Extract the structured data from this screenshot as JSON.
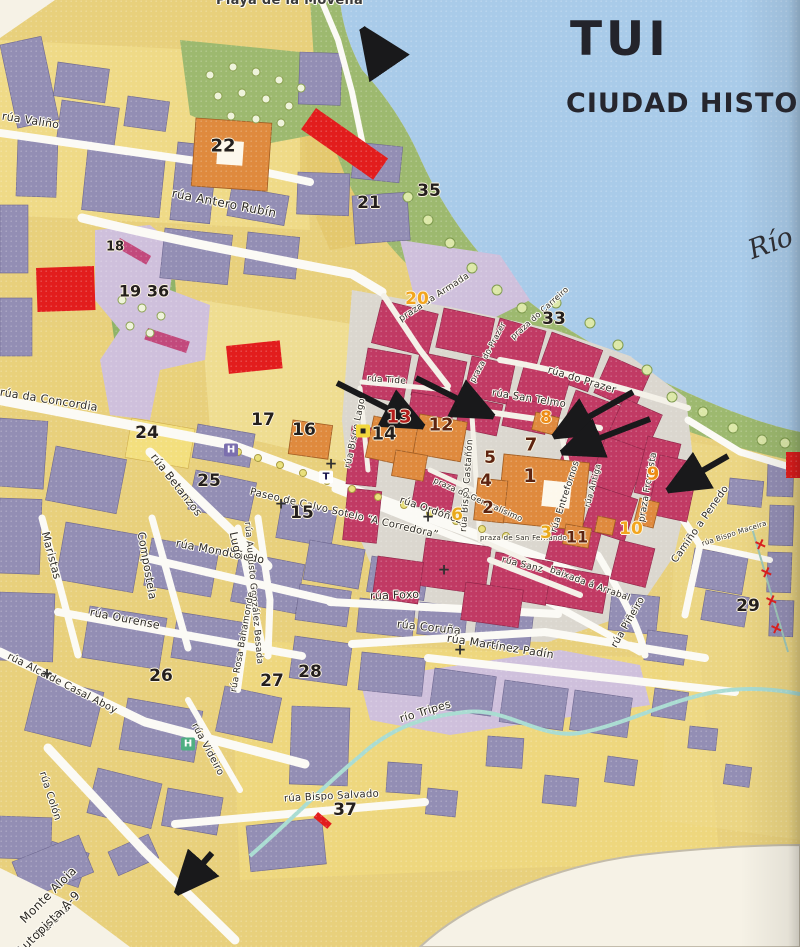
{
  "page": {
    "title": "TUI",
    "subtitle": "CIUDAD HISTO",
    "river_label": "Río",
    "beach_label": "Playa de la Movella"
  },
  "colors": {
    "water": "#a9cbe9",
    "shore_green": "#9db96f",
    "old_town_block": "#c13a64",
    "modern_block": "#938eb4",
    "monument_orange": "#df8a3e",
    "highlight_red": "#e21d1d",
    "street_white": "#fbfaf5",
    "lavender_zone": "#cfc0dc",
    "number_black": "#241f1d",
    "number_brown": "#5e2410",
    "number_orange": "#ee8b15",
    "number_yellow": "#e9a91c"
  },
  "streets": [
    {
      "t": "rúa Valiño",
      "x": 2,
      "y": 116,
      "r": 9,
      "s": 11
    },
    {
      "t": "rúa Antero Rubín",
      "x": 172,
      "y": 193,
      "r": 11,
      "s": 12
    },
    {
      "t": "praza da Armada",
      "x": 400,
      "y": 320,
      "r": -33,
      "s": 9
    },
    {
      "t": "praza do Carreiro",
      "x": 512,
      "y": 338,
      "r": -42,
      "s": 8
    },
    {
      "t": "praza do Prazer",
      "x": 472,
      "y": 382,
      "r": -62,
      "s": 8
    },
    {
      "t": "rúa do Prazer",
      "x": 548,
      "y": 370,
      "r": 17,
      "s": 10
    },
    {
      "t": "rúa San Telmo",
      "x": 492,
      "y": 393,
      "r": 9,
      "s": 10
    },
    {
      "t": "rúa Tide",
      "x": 367,
      "y": 379,
      "r": 4,
      "s": 9
    },
    {
      "t": "rúa Bispo Lago",
      "x": 348,
      "y": 468,
      "r": -78,
      "s": 9
    },
    {
      "t": "rúa Bispo Castañón",
      "x": 464,
      "y": 532,
      "r": -86,
      "s": 9
    },
    {
      "t": "rúa da Concordia",
      "x": 0,
      "y": 392,
      "r": 9,
      "s": 11
    },
    {
      "t": "rúa Betanzos",
      "x": 153,
      "y": 455,
      "r": 52,
      "s": 11
    },
    {
      "t": "rúa Mondoñedo",
      "x": 176,
      "y": 543,
      "r": 11,
      "s": 11
    },
    {
      "t": "Lugo",
      "x": 233,
      "y": 532,
      "r": 78,
      "s": 11
    },
    {
      "t": "Compostela",
      "x": 141,
      "y": 532,
      "r": 80,
      "s": 11
    },
    {
      "t": "Maristas",
      "x": 45,
      "y": 532,
      "r": 75,
      "s": 11
    },
    {
      "t": "rúa Ourense",
      "x": 90,
      "y": 612,
      "r": 11,
      "s": 11
    },
    {
      "t": "rúa Alcalde Casal Aboy",
      "x": 8,
      "y": 656,
      "r": 27,
      "s": 10
    },
    {
      "t": "rúa Colón",
      "x": 42,
      "y": 772,
      "r": 72,
      "s": 10
    },
    {
      "t": "rúa Augusto González Besada",
      "x": 247,
      "y": 522,
      "r": 85,
      "s": 9
    },
    {
      "t": "Paseo de Calvo Sotelo “A Corredora”",
      "x": 250,
      "y": 492,
      "r": 13,
      "s": 10
    },
    {
      "t": "rúa Ordóñez",
      "x": 400,
      "y": 500,
      "r": 19,
      "s": 10
    },
    {
      "t": "rúa Foxo",
      "x": 370,
      "y": 596,
      "r": -2,
      "s": 11
    },
    {
      "t": "rúa Coruña",
      "x": 397,
      "y": 624,
      "r": 6,
      "s": 11
    },
    {
      "t": "rúa Martínez Padín",
      "x": 447,
      "y": 638,
      "r": 9,
      "s": 11
    },
    {
      "t": "rúa Rosa Bahamonde",
      "x": 234,
      "y": 692,
      "r": -80,
      "s": 9
    },
    {
      "t": "río Tripes",
      "x": 400,
      "y": 719,
      "r": -17,
      "s": 11
    },
    {
      "t": "rúa Bispo Salvado",
      "x": 284,
      "y": 799,
      "r": -3,
      "s": 10
    },
    {
      "t": "rúa Videiro",
      "x": 194,
      "y": 724,
      "r": 62,
      "s": 10
    },
    {
      "t": "rúa Entrefornos",
      "x": 554,
      "y": 532,
      "r": -72,
      "s": 9
    },
    {
      "t": "rúa Antiga",
      "x": 587,
      "y": 507,
      "r": -75,
      "s": 8
    },
    {
      "t": "praza Fromista",
      "x": 642,
      "y": 522,
      "r": -80,
      "s": 9
    },
    {
      "t": "rúa Piñeiro",
      "x": 614,
      "y": 647,
      "r": -60,
      "s": 10
    },
    {
      "t": "baixada á Arrabal",
      "x": 550,
      "y": 570,
      "r": 20,
      "s": 9
    },
    {
      "t": "Camiño a Penedo",
      "x": 674,
      "y": 562,
      "r": -55,
      "s": 10
    },
    {
      "t": "rúa Bispo Maceira",
      "x": 702,
      "y": 544,
      "r": -18,
      "s": 7
    },
    {
      "t": "rúa Sanz",
      "x": 502,
      "y": 560,
      "r": 14,
      "s": 9
    },
    {
      "t": "praza de San Fernando",
      "x": 480,
      "y": 538,
      "r": 0,
      "s": 7
    },
    {
      "t": "praza do Generalísimo",
      "x": 434,
      "y": 480,
      "r": 24,
      "s": 8
    },
    {
      "t": "Monte Aloia",
      "x": 22,
      "y": 921,
      "r": -45,
      "s": 12
    },
    {
      "t": "Baiona",
      "x": 38,
      "y": 935,
      "r": -45,
      "s": 12
    },
    {
      "t": "Autopista A-9",
      "x": 18,
      "y": 953,
      "r": -45,
      "s": 12
    }
  ],
  "numbers": [
    {
      "n": "1",
      "x": 530,
      "y": 476,
      "c": "#5e2410",
      "s": 19
    },
    {
      "n": "2",
      "x": 488,
      "y": 508,
      "c": "#5e2410",
      "s": 17
    },
    {
      "n": "3",
      "x": 546,
      "y": 533,
      "c": "#e9a91c",
      "s": 17
    },
    {
      "n": "4",
      "x": 486,
      "y": 481,
      "c": "#5e2410",
      "s": 17
    },
    {
      "n": "5",
      "x": 490,
      "y": 458,
      "c": "#5e2410",
      "s": 17
    },
    {
      "n": "6",
      "x": 457,
      "y": 515,
      "c": "#e9a91c",
      "s": 17
    },
    {
      "n": "7",
      "x": 531,
      "y": 445,
      "c": "#5e2410",
      "s": 18
    },
    {
      "n": "8",
      "x": 546,
      "y": 418,
      "c": "#ee8b15",
      "s": 17
    },
    {
      "n": "9",
      "x": 653,
      "y": 474,
      "c": "#ee8b15",
      "s": 18
    },
    {
      "n": "10",
      "x": 631,
      "y": 529,
      "c": "#f2a51e",
      "s": 17
    },
    {
      "n": "11",
      "x": 577,
      "y": 537,
      "c": "#5e2410",
      "s": 16
    },
    {
      "n": "12",
      "x": 441,
      "y": 425,
      "c": "#5e2410",
      "s": 18
    },
    {
      "n": "13",
      "x": 399,
      "y": 417,
      "c": "#b21c1c",
      "s": 18
    },
    {
      "n": "14",
      "x": 384,
      "y": 434,
      "c": "#241f1d",
      "s": 18
    },
    {
      "n": "15",
      "x": 302,
      "y": 513,
      "c": "#241f1d",
      "s": 17
    },
    {
      "n": "16",
      "x": 304,
      "y": 430,
      "c": "#241f1d",
      "s": 17
    },
    {
      "n": "17",
      "x": 263,
      "y": 420,
      "c": "#241f1d",
      "s": 17
    },
    {
      "n": "18",
      "x": 115,
      "y": 247,
      "c": "#241f1d",
      "s": 13
    },
    {
      "n": "19",
      "x": 130,
      "y": 291,
      "c": "#241f1d",
      "s": 16
    },
    {
      "n": "20",
      "x": 417,
      "y": 299,
      "c": "#f2a51e",
      "s": 17
    },
    {
      "n": "21",
      "x": 369,
      "y": 203,
      "c": "#241f1d",
      "s": 17
    },
    {
      "n": "22",
      "x": 223,
      "y": 146,
      "c": "#241f1d",
      "s": 18
    },
    {
      "n": "24",
      "x": 147,
      "y": 433,
      "c": "#241f1d",
      "s": 17
    },
    {
      "n": "25",
      "x": 209,
      "y": 481,
      "c": "#241f1d",
      "s": 17
    },
    {
      "n": "26",
      "x": 161,
      "y": 676,
      "c": "#241f1d",
      "s": 17
    },
    {
      "n": "27",
      "x": 272,
      "y": 681,
      "c": "#241f1d",
      "s": 17
    },
    {
      "n": "28",
      "x": 310,
      "y": 672,
      "c": "#241f1d",
      "s": 17
    },
    {
      "n": "29",
      "x": 748,
      "y": 606,
      "c": "#241f1d",
      "s": 17
    },
    {
      "n": "33",
      "x": 554,
      "y": 319,
      "c": "#241f1d",
      "s": 17
    },
    {
      "n": "35",
      "x": 429,
      "y": 191,
      "c": "#241f1d",
      "s": 17
    },
    {
      "n": "36",
      "x": 158,
      "y": 291,
      "c": "#241f1d",
      "s": 16
    },
    {
      "n": "37",
      "x": 345,
      "y": 810,
      "c": "#241f1d",
      "s": 17
    }
  ],
  "markers": [
    {
      "k": "hotel-marker",
      "g": "H",
      "x": 231,
      "y": 450,
      "bg": "#7b6fae",
      "fg": "#ffffff"
    },
    {
      "k": "hotel-marker",
      "g": "H",
      "x": 188,
      "y": 744,
      "bg": "#4fae82",
      "fg": "#ffffff"
    },
    {
      "k": "taxi-marker",
      "g": "T",
      "x": 326,
      "y": 477,
      "bg": "#ffffff",
      "fg": "#15124a"
    },
    {
      "k": "fuel-station-marker",
      "g": "▪",
      "x": 363,
      "y": 431,
      "bg": "#f2d73c",
      "fg": "#222222"
    },
    {
      "k": "cruceiro-cross",
      "g": "+",
      "x": 331,
      "y": 464,
      "bg": "",
      "fg": "#2f2f2f"
    },
    {
      "k": "cruceiro-cross",
      "g": "+",
      "x": 281,
      "y": 504,
      "bg": "",
      "fg": "#2f2f2f"
    },
    {
      "k": "cruceiro-cross",
      "g": "+",
      "x": 428,
      "y": 517,
      "bg": "",
      "fg": "#2f2f2f"
    },
    {
      "k": "cruceiro-cross",
      "g": "+",
      "x": 444,
      "y": 570,
      "bg": "",
      "fg": "#2f2f2f"
    },
    {
      "k": "cruceiro-cross",
      "g": "+",
      "x": 47,
      "y": 674,
      "bg": "",
      "fg": "#2f2f2f"
    },
    {
      "k": "cruceiro-cross",
      "g": "+",
      "x": 460,
      "y": 650,
      "bg": "",
      "fg": "#2f2f2f"
    },
    {
      "k": "rail-cross",
      "g": "+",
      "x": 760,
      "y": 545,
      "bg": "",
      "fg": "#d81f1f"
    },
    {
      "k": "rail-cross",
      "g": "+",
      "x": 766,
      "y": 573,
      "bg": "",
      "fg": "#d81f1f"
    },
    {
      "k": "rail-cross",
      "g": "+",
      "x": 771,
      "y": 601,
      "bg": "",
      "fg": "#d81f1f"
    },
    {
      "k": "rail-cross",
      "g": "+",
      "x": 776,
      "y": 629,
      "bg": "",
      "fg": "#d81f1f"
    }
  ],
  "arrows": [
    {
      "x1": 388,
      "y1": 66,
      "x2": 362,
      "y2": 28,
      "w": 7
    },
    {
      "x1": 337,
      "y1": 383,
      "x2": 424,
      "y2": 427,
      "w": 6
    },
    {
      "x1": 416,
      "y1": 378,
      "x2": 494,
      "y2": 417,
      "w": 6
    },
    {
      "x1": 633,
      "y1": 392,
      "x2": 553,
      "y2": 437,
      "w": 6
    },
    {
      "x1": 650,
      "y1": 419,
      "x2": 561,
      "y2": 453,
      "w": 6
    },
    {
      "x1": 728,
      "y1": 456,
      "x2": 667,
      "y2": 491,
      "w": 6
    },
    {
      "x1": 212,
      "y1": 853,
      "x2": 176,
      "y2": 894,
      "w": 6
    }
  ]
}
